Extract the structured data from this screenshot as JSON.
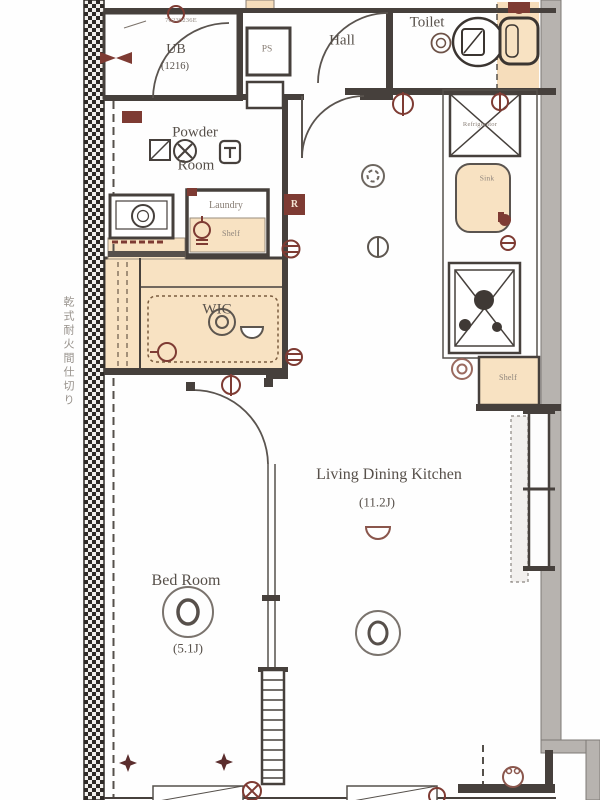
{
  "colors": {
    "wall": "#46403c",
    "tan_fill": "#f8e2c2",
    "symbol_maroon": "#7e3b33",
    "light_gray": "#6e6762",
    "outer_wall_gray": "#b7b3af",
    "text": "#57504a"
  },
  "rooms": {
    "ub": {
      "name": "UB",
      "size": "(1216)",
      "code": "70230236E"
    },
    "ps": {
      "name": "PS"
    },
    "hall": {
      "name": "Hall"
    },
    "toilet": {
      "name": "Toilet"
    },
    "powder_room": {
      "line1": "Powder",
      "line2": "Room"
    },
    "laundry": {
      "name": "Laundry",
      "shelf": "Shelf"
    },
    "wic": {
      "name": "WIC"
    },
    "kitchen": {
      "refrigerator": "Refrigerator",
      "sink": "Sink",
      "shelf": "Shelf"
    },
    "ldk": {
      "name": "Living Dining Kitchen",
      "size": "(11.2J)"
    },
    "bedroom": {
      "name": "Bed Room",
      "size": "(5.1J)"
    }
  },
  "annotations": {
    "partition_note": "乾式耐火間仕切り",
    "remote_symbol": "R"
  }
}
